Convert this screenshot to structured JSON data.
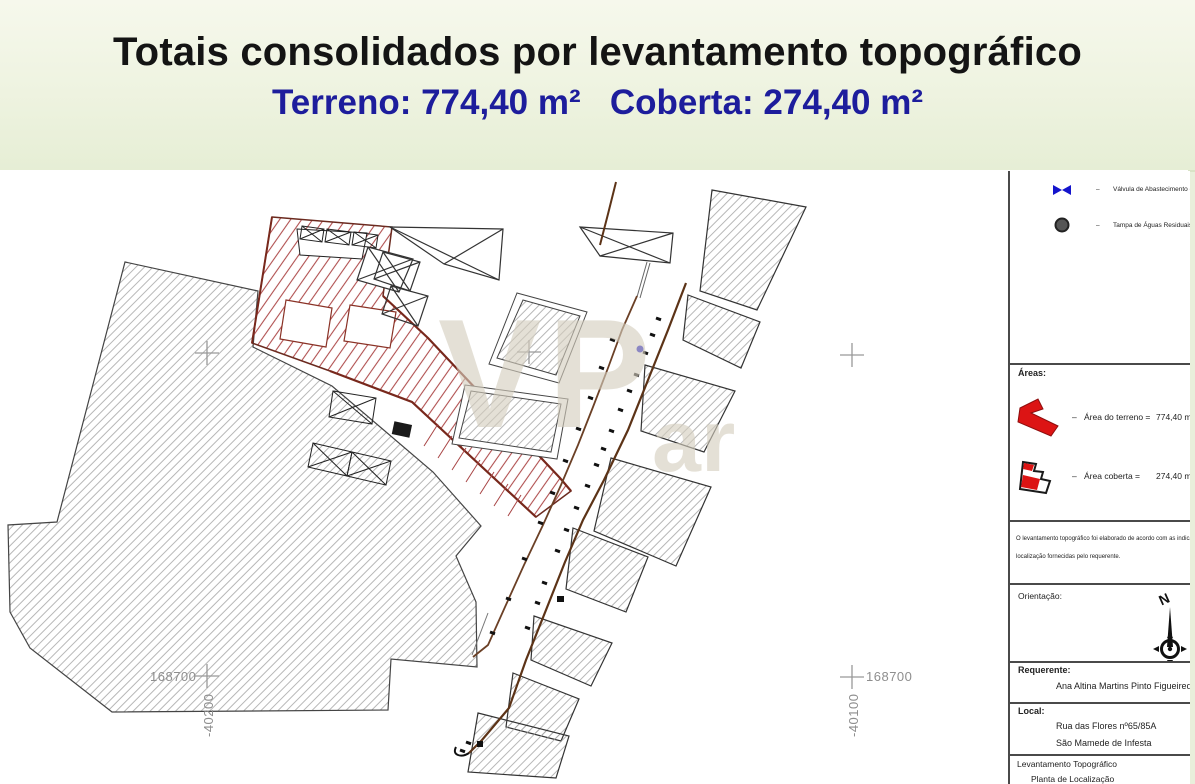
{
  "banner": {
    "title": "Totais consolidados por levantamento topográfico",
    "subtitle": "Terreno: 774,40 m²   Coberta: 274,40 m²"
  },
  "map": {
    "watermark_primary": "VP",
    "watermark_secondary": "ar",
    "coords": {
      "bottom_left_easting": "168700",
      "bottom_left_northing": "-40200",
      "bottom_right_easting": "168700",
      "bottom_right_northing": "-40100"
    }
  },
  "panel": {
    "dash": "–",
    "legend": {
      "valve_label": "Válvula de Abastecimento de Á",
      "manhole_label": "Tampa de Águas Residuais"
    },
    "areas": {
      "heading": "Áreas:",
      "terreno_label": "Área do terreno =",
      "terreno_value": "774,40 m2",
      "coberta_label": "Área coberta =",
      "coberta_value": "274,40 m2"
    },
    "note_line1": "O levantamento topográfico foi elaborado de acordo com as indicaçõ",
    "note_line2": "localização fornecidas pelo requerente.",
    "orientation": {
      "label": "Orientação:",
      "north": "N"
    },
    "requerente": {
      "label": "Requerente:",
      "name": "Ana Altina Martins Pinto Figueired"
    },
    "local": {
      "label": "Local:",
      "line1": "Rua das Flores nº65/85A",
      "line2": "São Mamede de Infesta"
    },
    "doc": {
      "title": "Levantamento Topográfico",
      "subtitle": "Planta de Localização"
    }
  },
  "colors": {
    "accent_blue": "#1d1d9c",
    "parcel_red": "#b05050",
    "terrain_hatch_gray": "#a5a5a5",
    "road_brown": "#5c3317",
    "valve_blue": "#1414cc"
  }
}
